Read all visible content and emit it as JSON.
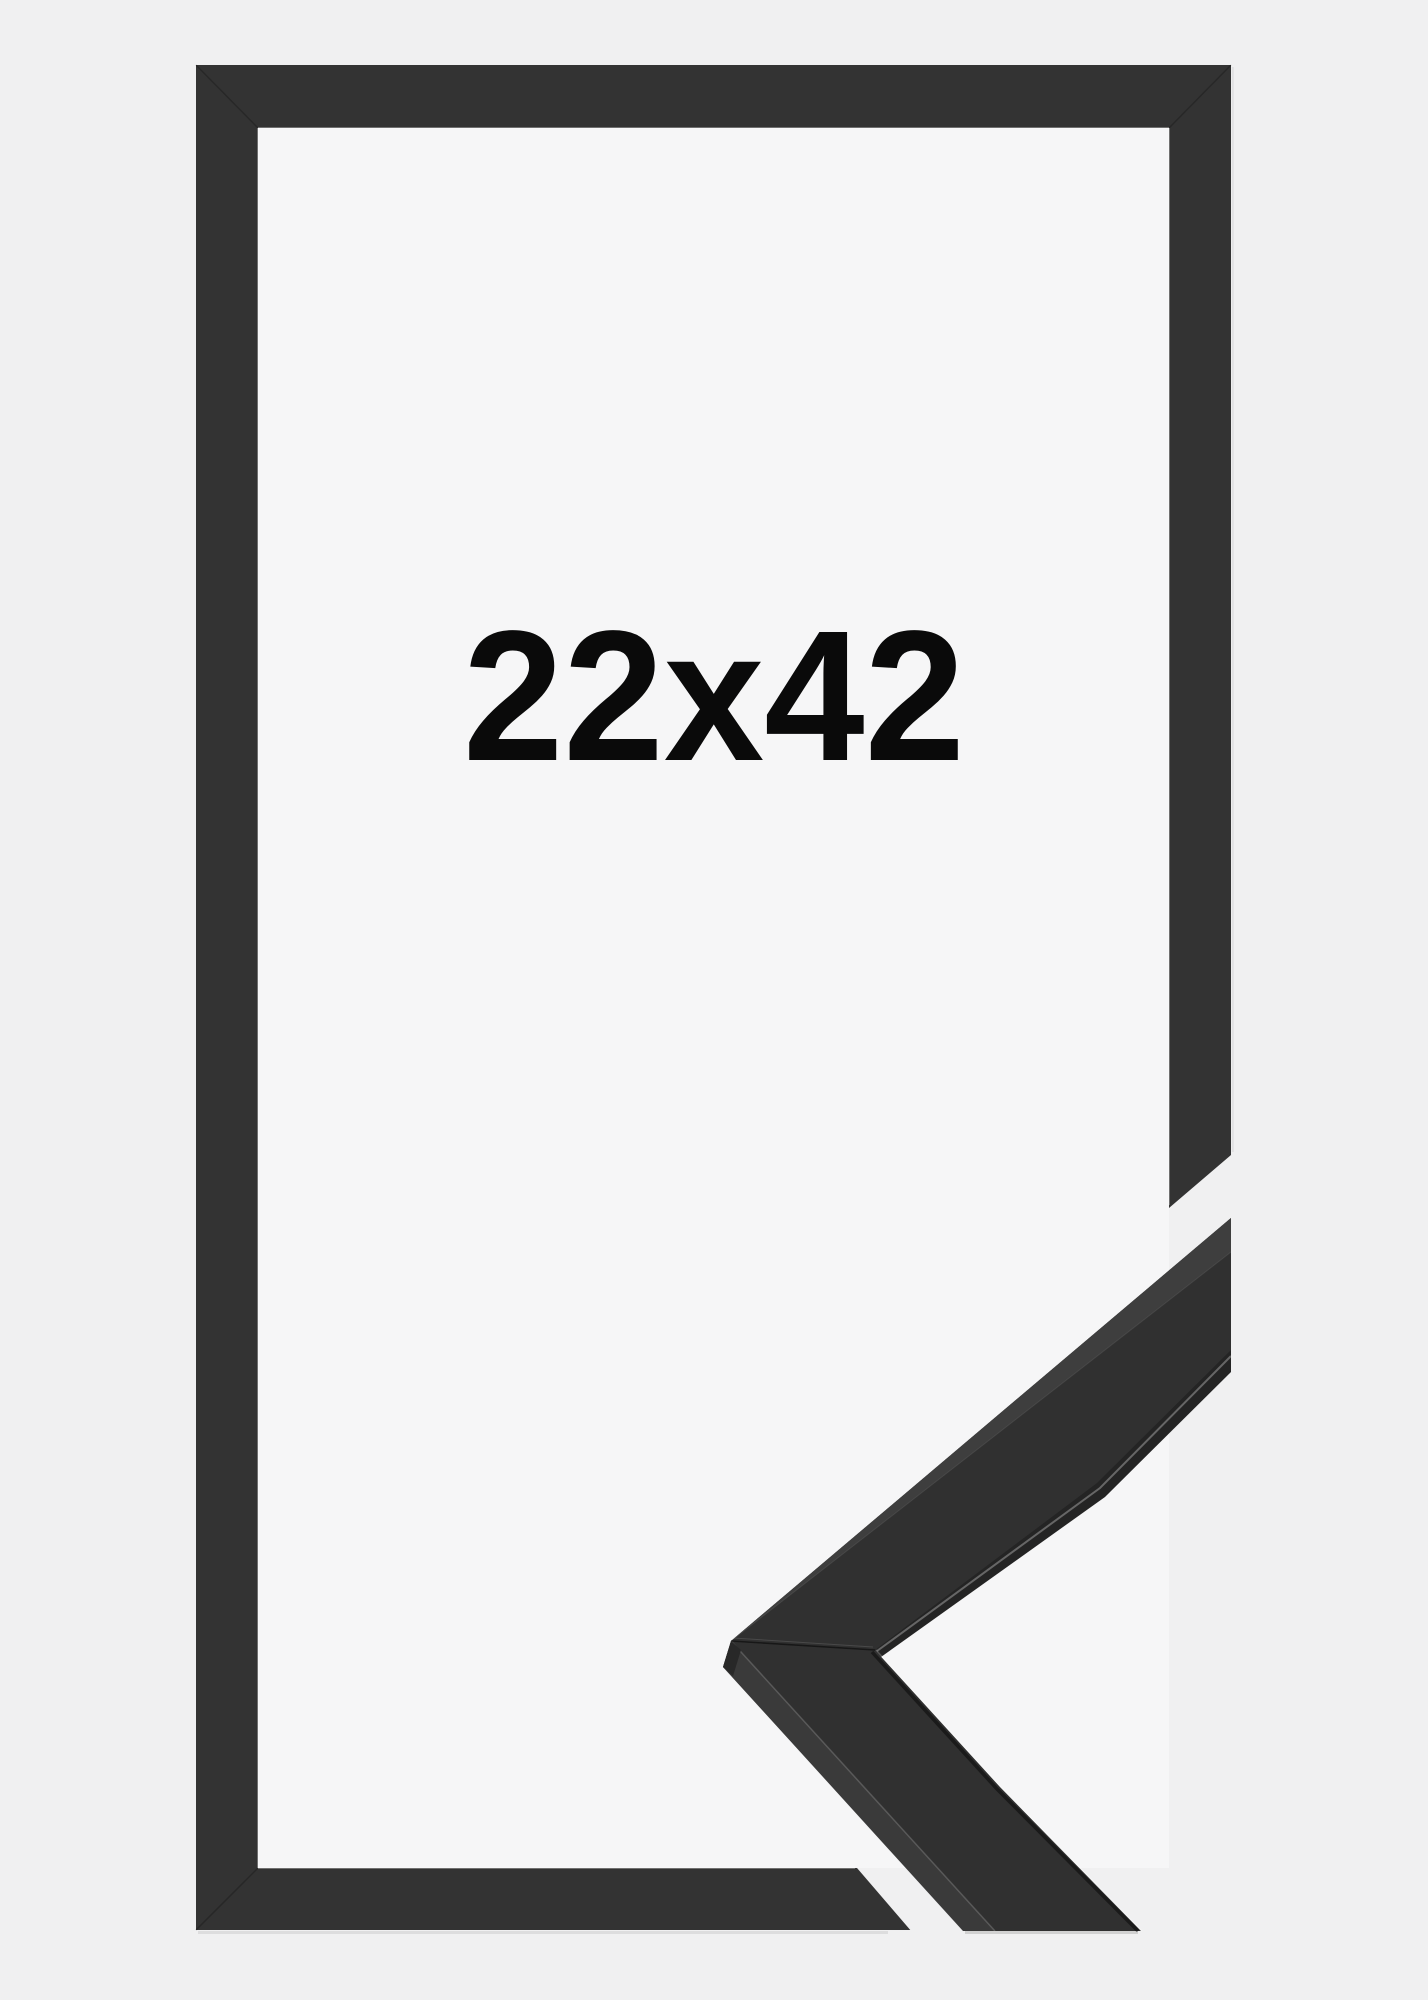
{
  "product_image": {
    "size_label": "22x42",
    "colors": {
      "background": "#f0f0f1",
      "interior": "#f6f6f7",
      "frame": "#333333",
      "moulding_front": "#303030",
      "moulding_top": "#3e3e3e",
      "moulding_side": "#3a3a3a",
      "moulding_band": "#242424",
      "moulding_end": "#282828",
      "label": "#0a0a0a"
    }
  }
}
